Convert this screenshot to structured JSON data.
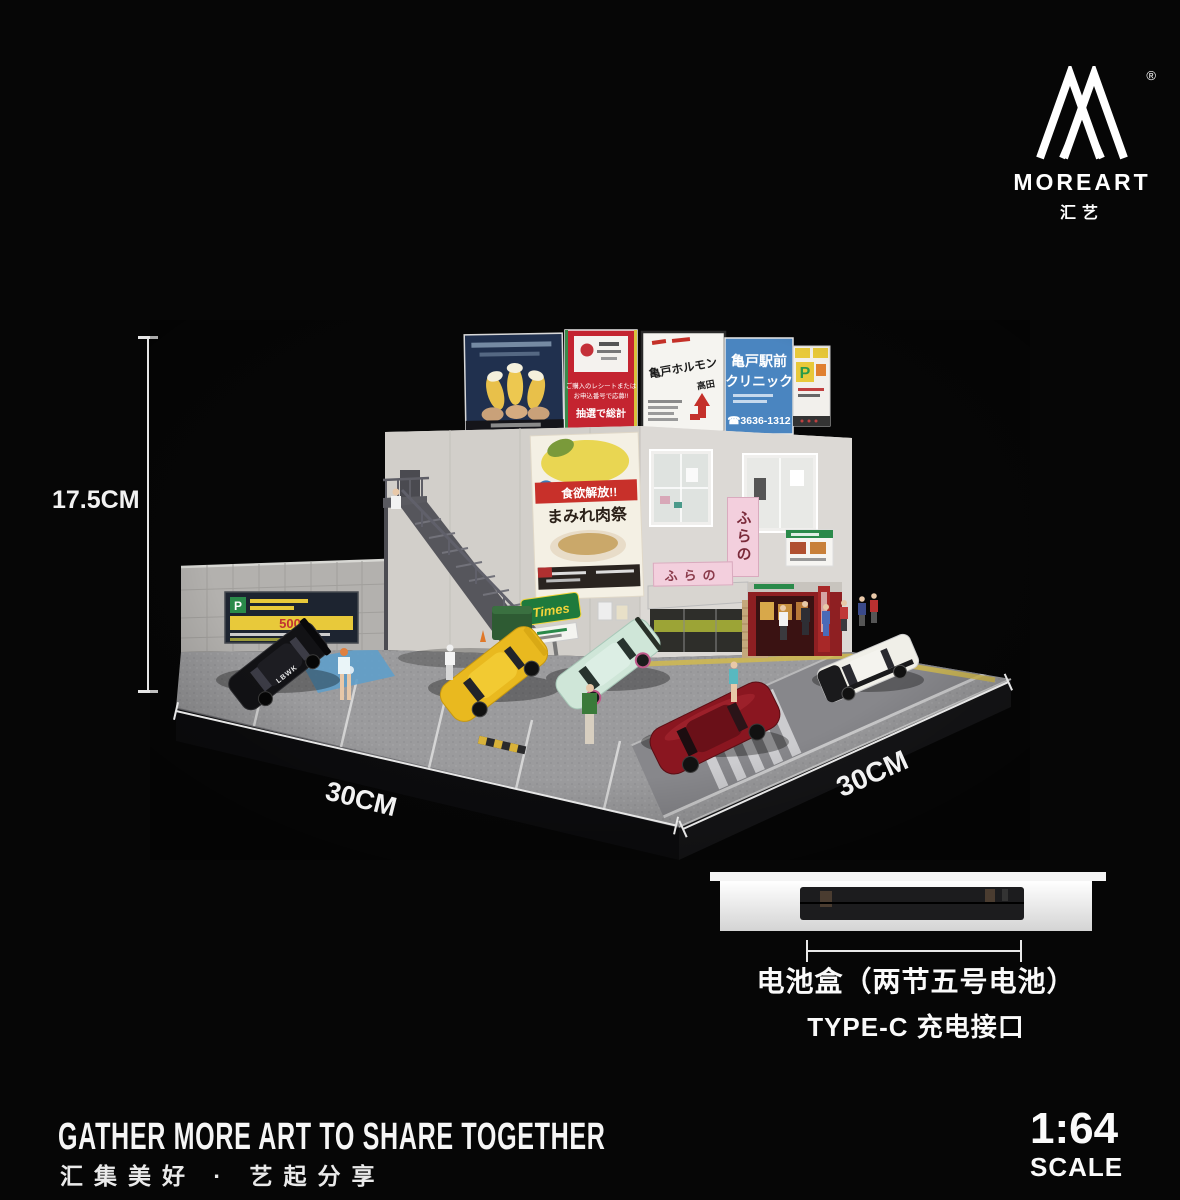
{
  "brand": {
    "name": "MOREART",
    "name_cn": "汇艺",
    "registered_mark": "®"
  },
  "measurements": {
    "height": "17.5CM",
    "width_front": "30CM",
    "width_side": "30CM"
  },
  "battery_info": {
    "box_label": "电池盒（两节五号电池）",
    "port_label": "TYPE-C 充电接口"
  },
  "footer": {
    "slogan_en": "GATHER MORE ART TO SHARE TOGETHER",
    "slogan_cn": "汇集美好 · 艺起分享",
    "scale": "1:64",
    "scale_label": "SCALE"
  },
  "colors": {
    "asahi_red": "#c42430",
    "clinic_blue": "#4a85c0",
    "times_green": "#1e7a3c",
    "furano_pink": "#f3cfdd",
    "poster_red": "#c8302a"
  },
  "diorama": {
    "rooftop_billboards": {
      "asahi_panel": {
        "line1": "ご購入のレシートまたは",
        "line2": "お申込番号で応募!!",
        "line3": "抽選で総計"
      },
      "restaurant_panel": {
        "title": "亀戸ホルモン",
        "subtitle": "高田"
      },
      "clinic_panel": {
        "line1": "亀戸駅前",
        "line2": "クリニック",
        "phone": "☎3636-1312"
      },
      "parking_panel": {
        "label": "P"
      }
    },
    "wall_poster": {
      "line1": "食欲解放!!",
      "line2": "まみれ肉祭"
    },
    "parking_billboard": {
      "label": "P",
      "price": "500"
    },
    "times_sign": {
      "label": "Times"
    },
    "shop_sign": {
      "label": "ふらの"
    },
    "car_livery": {
      "label": "LBWK"
    }
  }
}
